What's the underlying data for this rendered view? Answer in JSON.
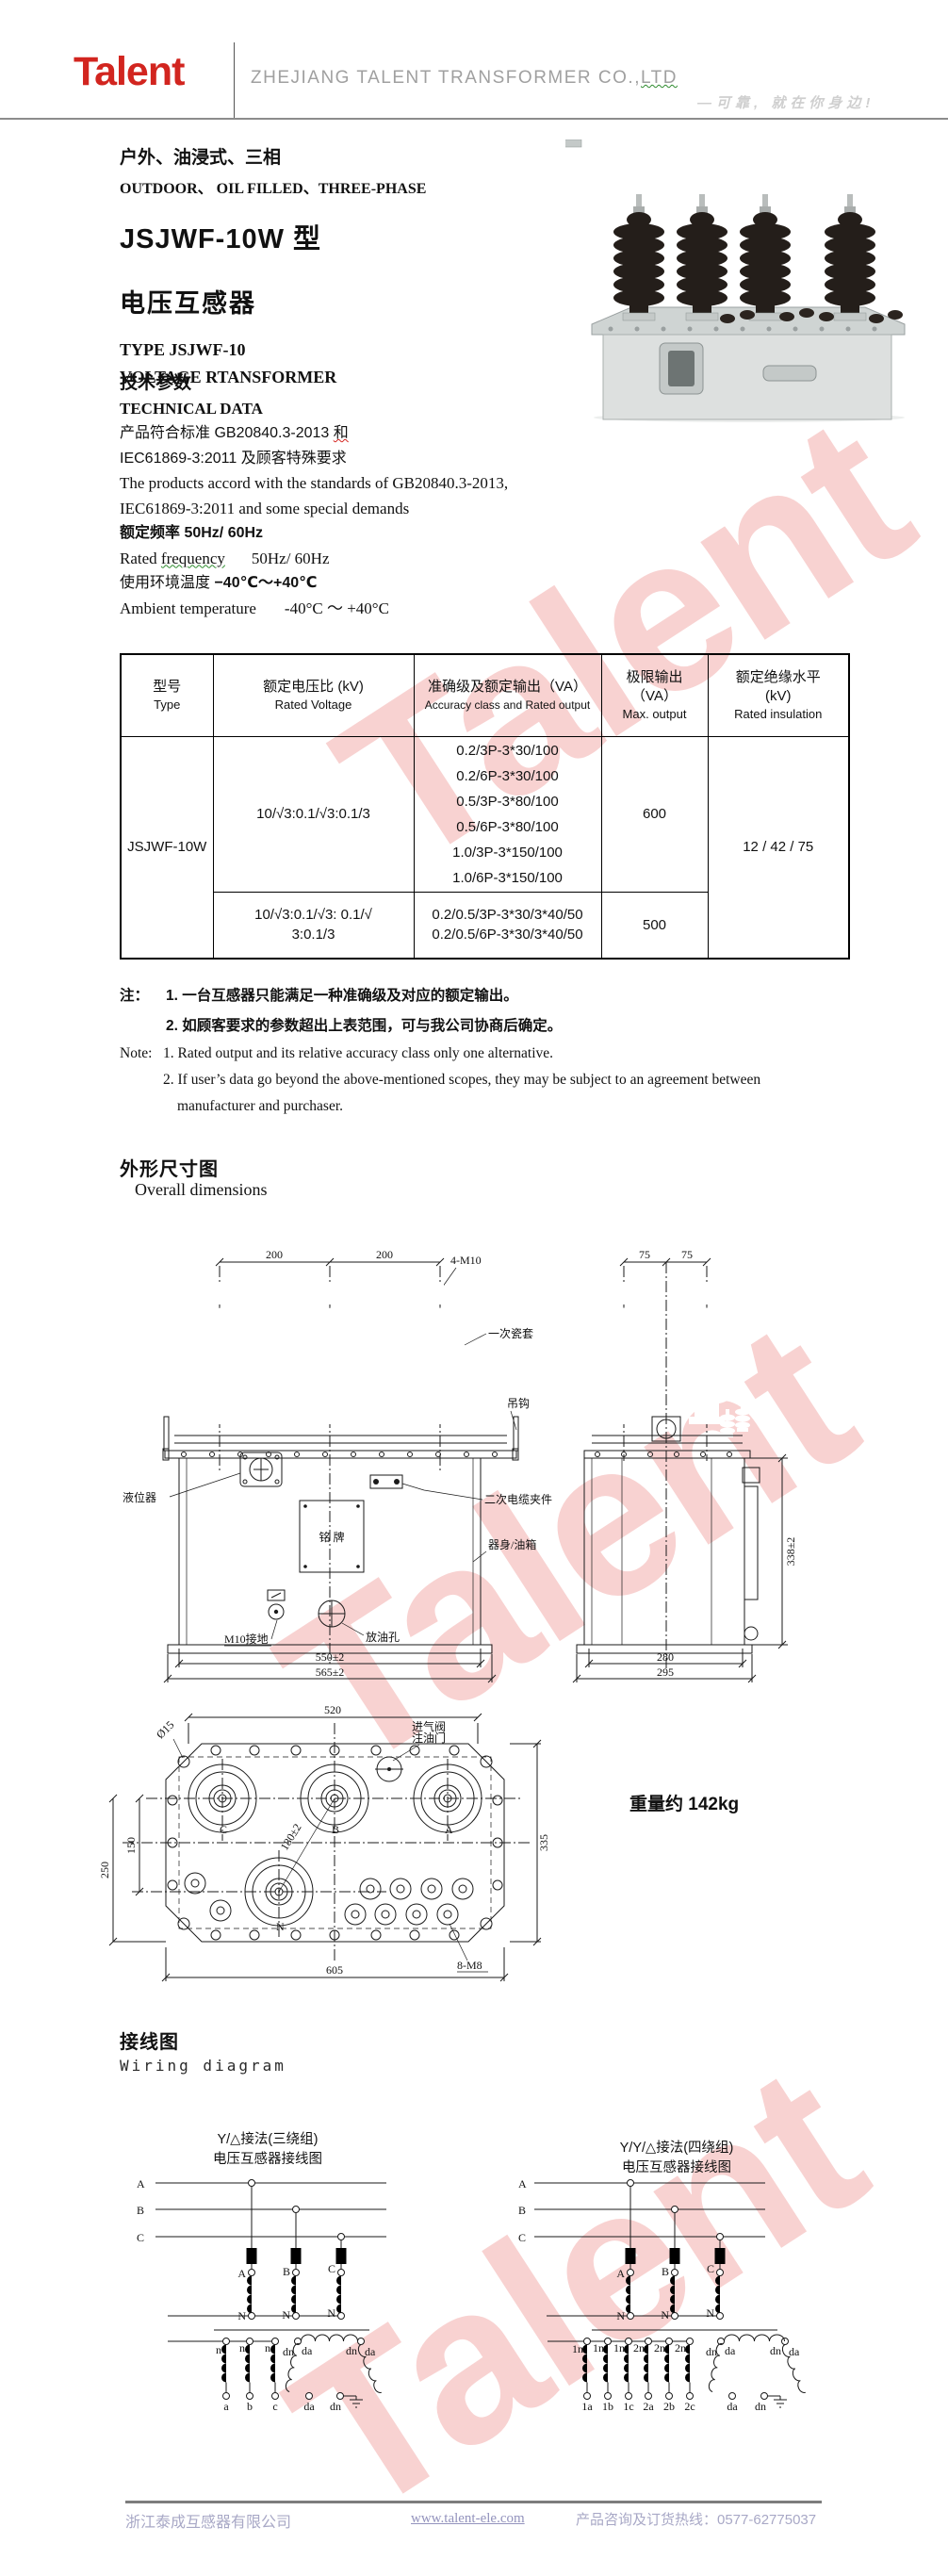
{
  "watermark": "Talent",
  "colors": {
    "brand_red": "#d2251f",
    "watermark_pink": "rgba(224,48,44,0.22)",
    "header_gray": "#a0a0a0",
    "tagline_gray": "#cfcfcf",
    "footer_text": "#a8a8c6"
  },
  "header": {
    "logo": "Talent",
    "company_main": "ZHEJIANG TALENT TRANSFORMER CO.,",
    "company_tail": "LTD",
    "tagline": "—可靠, 就在你身边!"
  },
  "title": {
    "cn1": "户外、油浸式、三相",
    "en1": "OUTDOOR、 OIL FILLED、THREE-PHASE",
    "model": "JSJWF-10W 型",
    "product_cn": "电压互感器",
    "type_en": "TYPE JSJWF-10",
    "product_en": "VOLTAGE RTANSFORMER"
  },
  "tech": {
    "heading_cn": "技术参数",
    "heading_en": "TECHNICAL DATA",
    "std_cn1_a": "产品符合标准 GB20840.3-2013 ",
    "std_cn1_b": "和",
    "std_cn2": "IEC61869-3:2011 及顾客特殊要求",
    "std_en1": "The products accord with the standards of GB20840.3-2013,",
    "std_en2": "IEC61869-3:2011 and some special demands",
    "freq_cn": "额定频率 50Hz/ 60Hz",
    "freq_en_a": "Rated ",
    "freq_en_b": "frequency",
    "freq_en_c": "50Hz/ 60Hz",
    "temp_cn_a": "使用环境温度 ",
    "temp_cn_b": "−40℃～+40℃",
    "temp_en_a": "Ambient temperature",
    "temp_en_b": "-40°C ～ +40°C"
  },
  "table": {
    "h1": {
      "cn": "型号",
      "en": "Type"
    },
    "h2": {
      "cn": "额定电压比 (kV)",
      "en": "Rated Voltage"
    },
    "h3": {
      "cn": "准确级及额定输出（VA）",
      "en": "Accuracy class and Rated output"
    },
    "h4": {
      "cn": "极限输出",
      "cn2": "（VA）",
      "en": "Max. output"
    },
    "h5": {
      "cn": "额定绝缘水平",
      "cn2": "(kV)",
      "en": "Rated insulation"
    },
    "type": "JSJWF-10W",
    "r1_voltage": "10/√3:0.1/√3:0.1/3",
    "r1_outputs": [
      "0.2/3P-3*30/100",
      "0.2/6P-3*30/100",
      "0.5/3P-3*80/100",
      "0.5/6P-3*80/100",
      "1.0/3P-3*150/100",
      "1.0/6P-3*150/100"
    ],
    "r1_max": "600",
    "r2_voltage_l1": "10/√3:0.1/√3: 0.1/√",
    "r2_voltage_l2": "3:0.1/3",
    "r2_outputs": [
      "0.2/0.5/3P-3*30/3*40/50",
      "0.2/0.5/6P-3*30/3*40/50"
    ],
    "r2_max": "500",
    "insulation": "12 / 42 / 75"
  },
  "notes": {
    "cn_label": "注：",
    "cn1": "1. 一台互感器只能满足一种准确级及对应的额定输出。",
    "cn2": "2. 如顾客要求的参数超出上表范围，可与我公司协商后确定。",
    "en_label": "Note:",
    "en1": "1. Rated output and its relative accuracy class only one alternative.",
    "en2": "2. If user’s data go beyond the above-mentioned scopes, they may be subject to an agreement between",
    "en3": "manufacturer and purchaser."
  },
  "dims": {
    "heading_cn": "外形尺寸图",
    "heading_en": "Overall dimensions",
    "weight": "重量约 142kg",
    "front": {
      "d200": "200",
      "bolt": "4-M10",
      "bushing": "一次瓷套",
      "hook": "吊钩",
      "level": "液位器",
      "clamp": "二次电缆夹件",
      "nameplate": "铭 牌",
      "tank": "器身/油箱",
      "ground": "M10接地",
      "drain": "放油孔",
      "d550": "550±2",
      "d565": "565±2"
    },
    "side": {
      "d75": "75",
      "d338": "338±2",
      "d280": "280",
      "d295": "295"
    },
    "top": {
      "d520": "520",
      "d15": "Ø15",
      "valve1": "进气阀",
      "valve2": "注油门",
      "d250": "250",
      "d150": "150",
      "d180": "180±2",
      "d335": "335",
      "d605": "605",
      "bolt": "8-M8",
      "tC": "C",
      "tB": "B",
      "tA": "A",
      "tN": "N"
    }
  },
  "wiring": {
    "heading_cn": "接线图",
    "heading_en": "Wiring diagram",
    "bus": [
      "A",
      "B",
      "C"
    ],
    "prim": [
      "A",
      "B",
      "C"
    ],
    "n": "N",
    "left": {
      "title1": "Y/△接法(三绕组)",
      "title2": "电压互感器接线图",
      "sec_top": [
        "n",
        "n",
        "n"
      ],
      "sec_bottom": [
        "a",
        "b",
        "c"
      ],
      "delta_top": [
        "dn",
        "da",
        "dn",
        "da"
      ],
      "delta_bottom": [
        "da",
        "dn"
      ]
    },
    "right": {
      "title1": "Y/Y/△接法(四绕组)",
      "title2": "电压互感器接线图",
      "sec_top": [
        "1n",
        "1n",
        "1n",
        "2n",
        "2n",
        "2n"
      ],
      "sec_bottom": [
        "1a",
        "1b",
        "1c",
        "2a",
        "2b",
        "2c"
      ],
      "delta_top": [
        "dn",
        "da",
        "dn",
        "da"
      ],
      "delta_bottom": [
        "da",
        "dn"
      ]
    }
  },
  "footer": {
    "company": "浙江泰成互感器有限公司",
    "website": "www.talent-ele.com",
    "hotline": "产品咨询及订货热线：0577-62775037"
  }
}
